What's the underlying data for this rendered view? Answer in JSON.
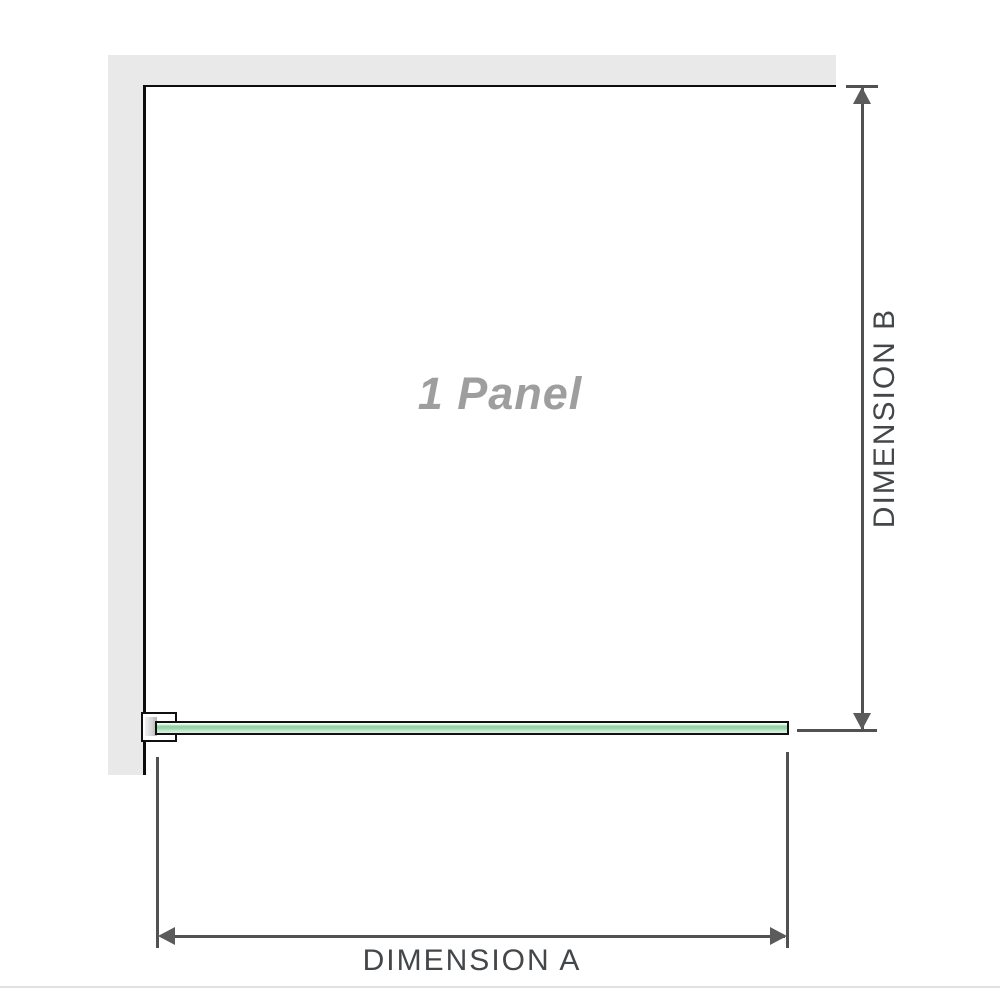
{
  "diagram": {
    "panel_label": "1 Panel",
    "dimension_a_label": "DIMENSION A",
    "dimension_b_label": "DIMENSION B"
  },
  "colors": {
    "wall": "#eae9ea",
    "panel_border": "#0d0d0d",
    "glass_green": "#94d1a5",
    "dimension_line": "#515151",
    "dimension_label_text": "#43474a",
    "panel_label_text": "#9e9e9e",
    "bottom_divider": "#dfe2e3"
  }
}
